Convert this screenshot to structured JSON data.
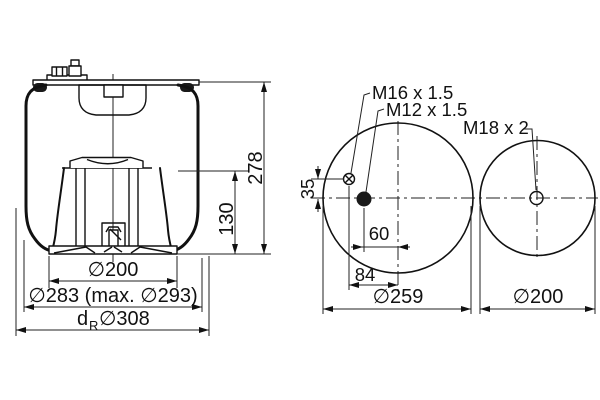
{
  "drawing_type": "air-spring-technical-drawing",
  "colors": {
    "line": "#1a1a1a",
    "background": "#ffffff"
  },
  "side_view": {
    "height_total": "278",
    "height_piston": "130",
    "dia_piston": "∅200",
    "dia_bellows_max": "∅283 (max. ∅293)",
    "dia_rolling": {
      "prefix": "d",
      "sub": "R",
      "value": "∅308"
    }
  },
  "top_view_left": {
    "air_fitting_label": "M16 x 1.5",
    "stud_label": "M12 x 1.5",
    "offset_vertical": "35",
    "offset_stud": "60",
    "offset_fitting": "84",
    "diameter": "∅259"
  },
  "top_view_right": {
    "stud_label": "M18 x 2",
    "diameter": "∅200"
  }
}
